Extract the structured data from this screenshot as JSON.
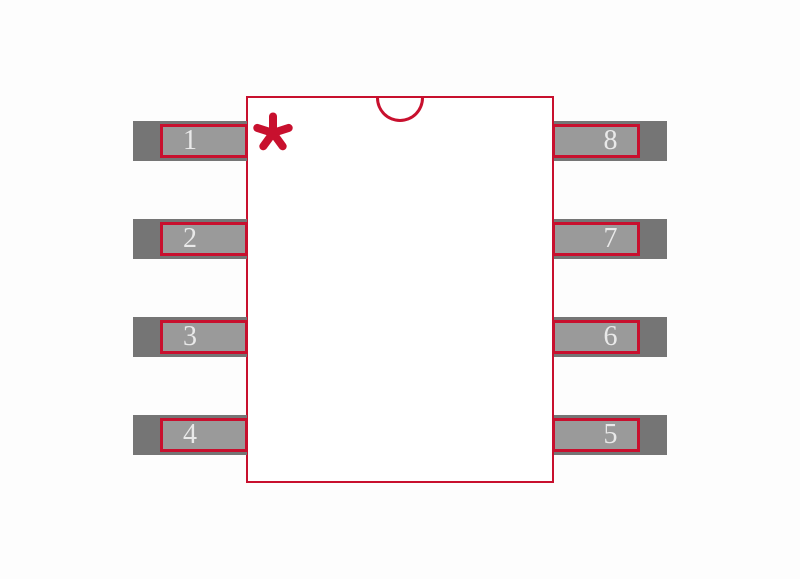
{
  "pins": [
    {
      "number": "1",
      "side": "left",
      "row": 1
    },
    {
      "number": "2",
      "side": "left",
      "row": 2
    },
    {
      "number": "3",
      "side": "left",
      "row": 3
    },
    {
      "number": "4",
      "side": "left",
      "row": 4
    },
    {
      "number": "5",
      "side": "right",
      "row": 4
    },
    {
      "number": "6",
      "side": "right",
      "row": 3
    },
    {
      "number": "7",
      "side": "right",
      "row": 2
    },
    {
      "number": "8",
      "side": "right",
      "row": 1
    }
  ],
  "icons": {
    "pin1_marker": "asterisk-icon",
    "orientation_notch": "half-circle-notch-icon"
  },
  "colors": {
    "accent_red": "#C8102E",
    "pad_gray": "#9A9A9A",
    "lead_gray": "#757575",
    "body_fill": "#FFFFFF",
    "background": "#FDFDFD",
    "pin_number_text": "#E9E9E9"
  }
}
